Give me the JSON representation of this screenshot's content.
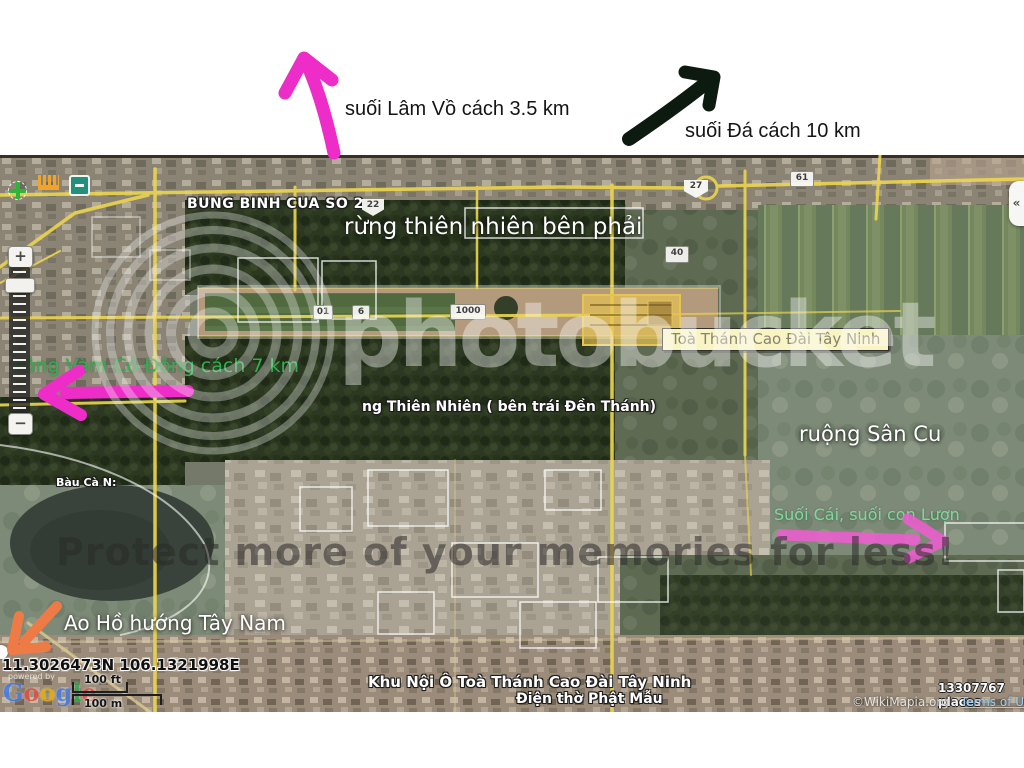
{
  "top_annotations": {
    "lam_vo": {
      "label": "suối Lâm Vồ cách 3.5 km",
      "color": "#ee2cc8"
    },
    "da": {
      "label": "suối Đá cách 10 km",
      "color": "#0d1a10"
    }
  },
  "map": {
    "roundabout_label": "BUNG BINH CUA SO 2",
    "forest_right_label": "rừng thiên nhiên bên phải",
    "temple_tooltip": "Toà Thánh Cao Đài Tây Ninh",
    "river_annotation": "sông Vàm Cỏ Đông cách 7 km",
    "river_arrow_color": "#ee2cc8",
    "forest_left_label": "ng Thiên Nhiên ( bên trái Đền Thánh)",
    "field_label": "ruộng Sân Cu",
    "pond_label": "Bàu Cà N:",
    "stream_annotation": "Suối Cái, suối con Lượn",
    "stream_arrow_color": "#f05ad2",
    "lake_annotation": "Ao Hồ hướng Tây Nam",
    "lake_arrow_color": "#ee7b46",
    "complex_label": "Khu Nội Ô Toà Thánh Cao Đài Tây Ninh",
    "shrine_label": "Điện thờ Phật Mẫu",
    "shields": {
      "s22": "22",
      "s27": "27",
      "s61": "61",
      "s40": "40",
      "s01": "01",
      "s6": "6",
      "s1000": "1000"
    }
  },
  "watermark": {
    "brand": "photobucket",
    "tagline": "Protect more of your memories for less!"
  },
  "controls": {
    "zoom_in": "+",
    "zoom_out": "−",
    "collapse": "«"
  },
  "footer": {
    "coordinates": "11.3026473N 106.1321998E",
    "powered_by": "powered by",
    "google_letters": [
      "G",
      "o",
      "o",
      "g",
      "l",
      "e"
    ],
    "scale_ft": "100 ft",
    "scale_m": "100 m",
    "places_count": "13307767 places",
    "attribution": "©WikiMapia.org -",
    "terms_link": "Terms of Use"
  }
}
